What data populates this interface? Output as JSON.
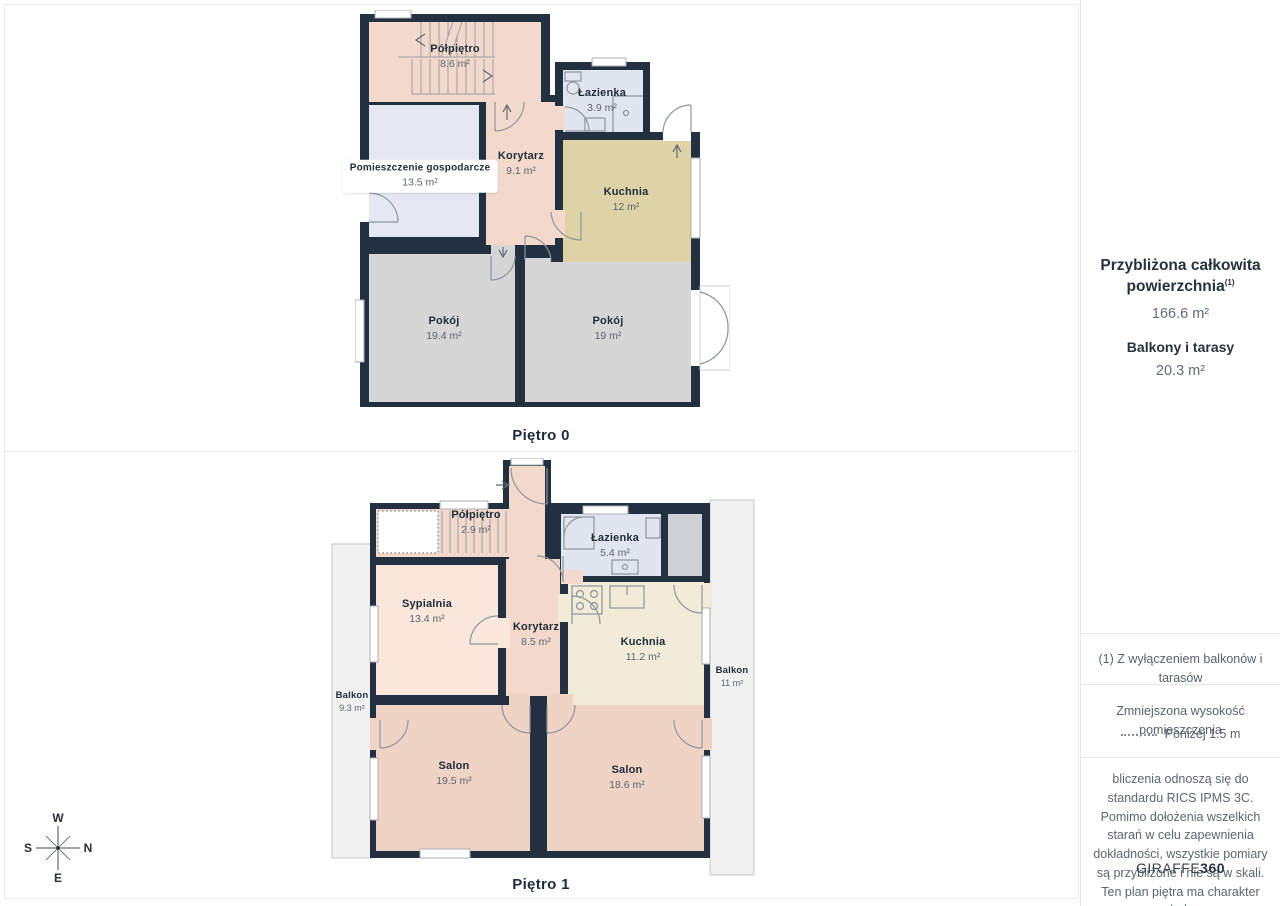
{
  "floors": [
    {
      "title": "Piętro 0",
      "rooms": [
        {
          "name": "Półpiętro",
          "area": "8.6 m²"
        },
        {
          "name": "Łazienka",
          "area": "3.9 m²"
        },
        {
          "name": "Pomieszczenie gospodarcze",
          "area": "13.5 m²"
        },
        {
          "name": "Korytarz",
          "area": "9.1 m²"
        },
        {
          "name": "Kuchnia",
          "area": "12 m²"
        },
        {
          "name": "Pokój",
          "area": "19.4 m²"
        },
        {
          "name": "Pokój",
          "area": "19 m²"
        }
      ]
    },
    {
      "title": "Piętro 1",
      "rooms": [
        {
          "name": "Półpiętro",
          "area": "2.9 m²"
        },
        {
          "name": "Łazienka",
          "area": "5.4 m²"
        },
        {
          "name": "Sypialnia",
          "area": "13.4 m²"
        },
        {
          "name": "Korytarz",
          "area": "8.5 m²"
        },
        {
          "name": "Kuchnia",
          "area": "11.2 m²"
        },
        {
          "name": "Balkon",
          "area": "9.3 m²"
        },
        {
          "name": "Balkon",
          "area": "11 m²"
        },
        {
          "name": "Salon",
          "area": "19.5 m²"
        },
        {
          "name": "Salon",
          "area": "18.6 m²"
        }
      ]
    }
  ],
  "compass": {
    "top": "W",
    "right": "N",
    "left": "S",
    "bottom": "E"
  },
  "sidebar": {
    "title_line1": "Przybliżona całkowita",
    "title_line2": "powierzchnia",
    "title_sup": "(1)",
    "total_value": "166.6 m²",
    "balconies_label": "Balkony i tarasy",
    "balconies_value": "20.3 m²",
    "footnote": "(1) Z wyłączeniem balkonów i tarasów",
    "reduced_label": "Zmniejszona wysokość pomieszczenia",
    "reduced_value": "Poniżej 1.5 m",
    "disclaimer": "bliczenia odnoszą się do standardu RICS IPMS 3C. Pomimo dołożenia wszelkich starań w celu zapewnienia dokładności, wszystkie pomiary są przybliżone i nie są w skali. Ten plan piętra ma charakter poglądowy.",
    "brand": "GIRAFFE",
    "brand_bold": "360"
  },
  "colors": {
    "wall": "#22303f",
    "corridor_pink": "#f2d9cb",
    "salon_pink": "#efd3c4",
    "bedroom_pink": "#f8e7da",
    "kitchen_khaki": "#ddd3a6",
    "kitchen_cream": "#f1ebd7",
    "room_gray": "#d6d6d7",
    "bath_blue": "#e0e5ef",
    "utility_lavender": "#e5e8f2",
    "closet_gray": "#ced2d7",
    "balcony_gray": "#f1f1f2"
  }
}
